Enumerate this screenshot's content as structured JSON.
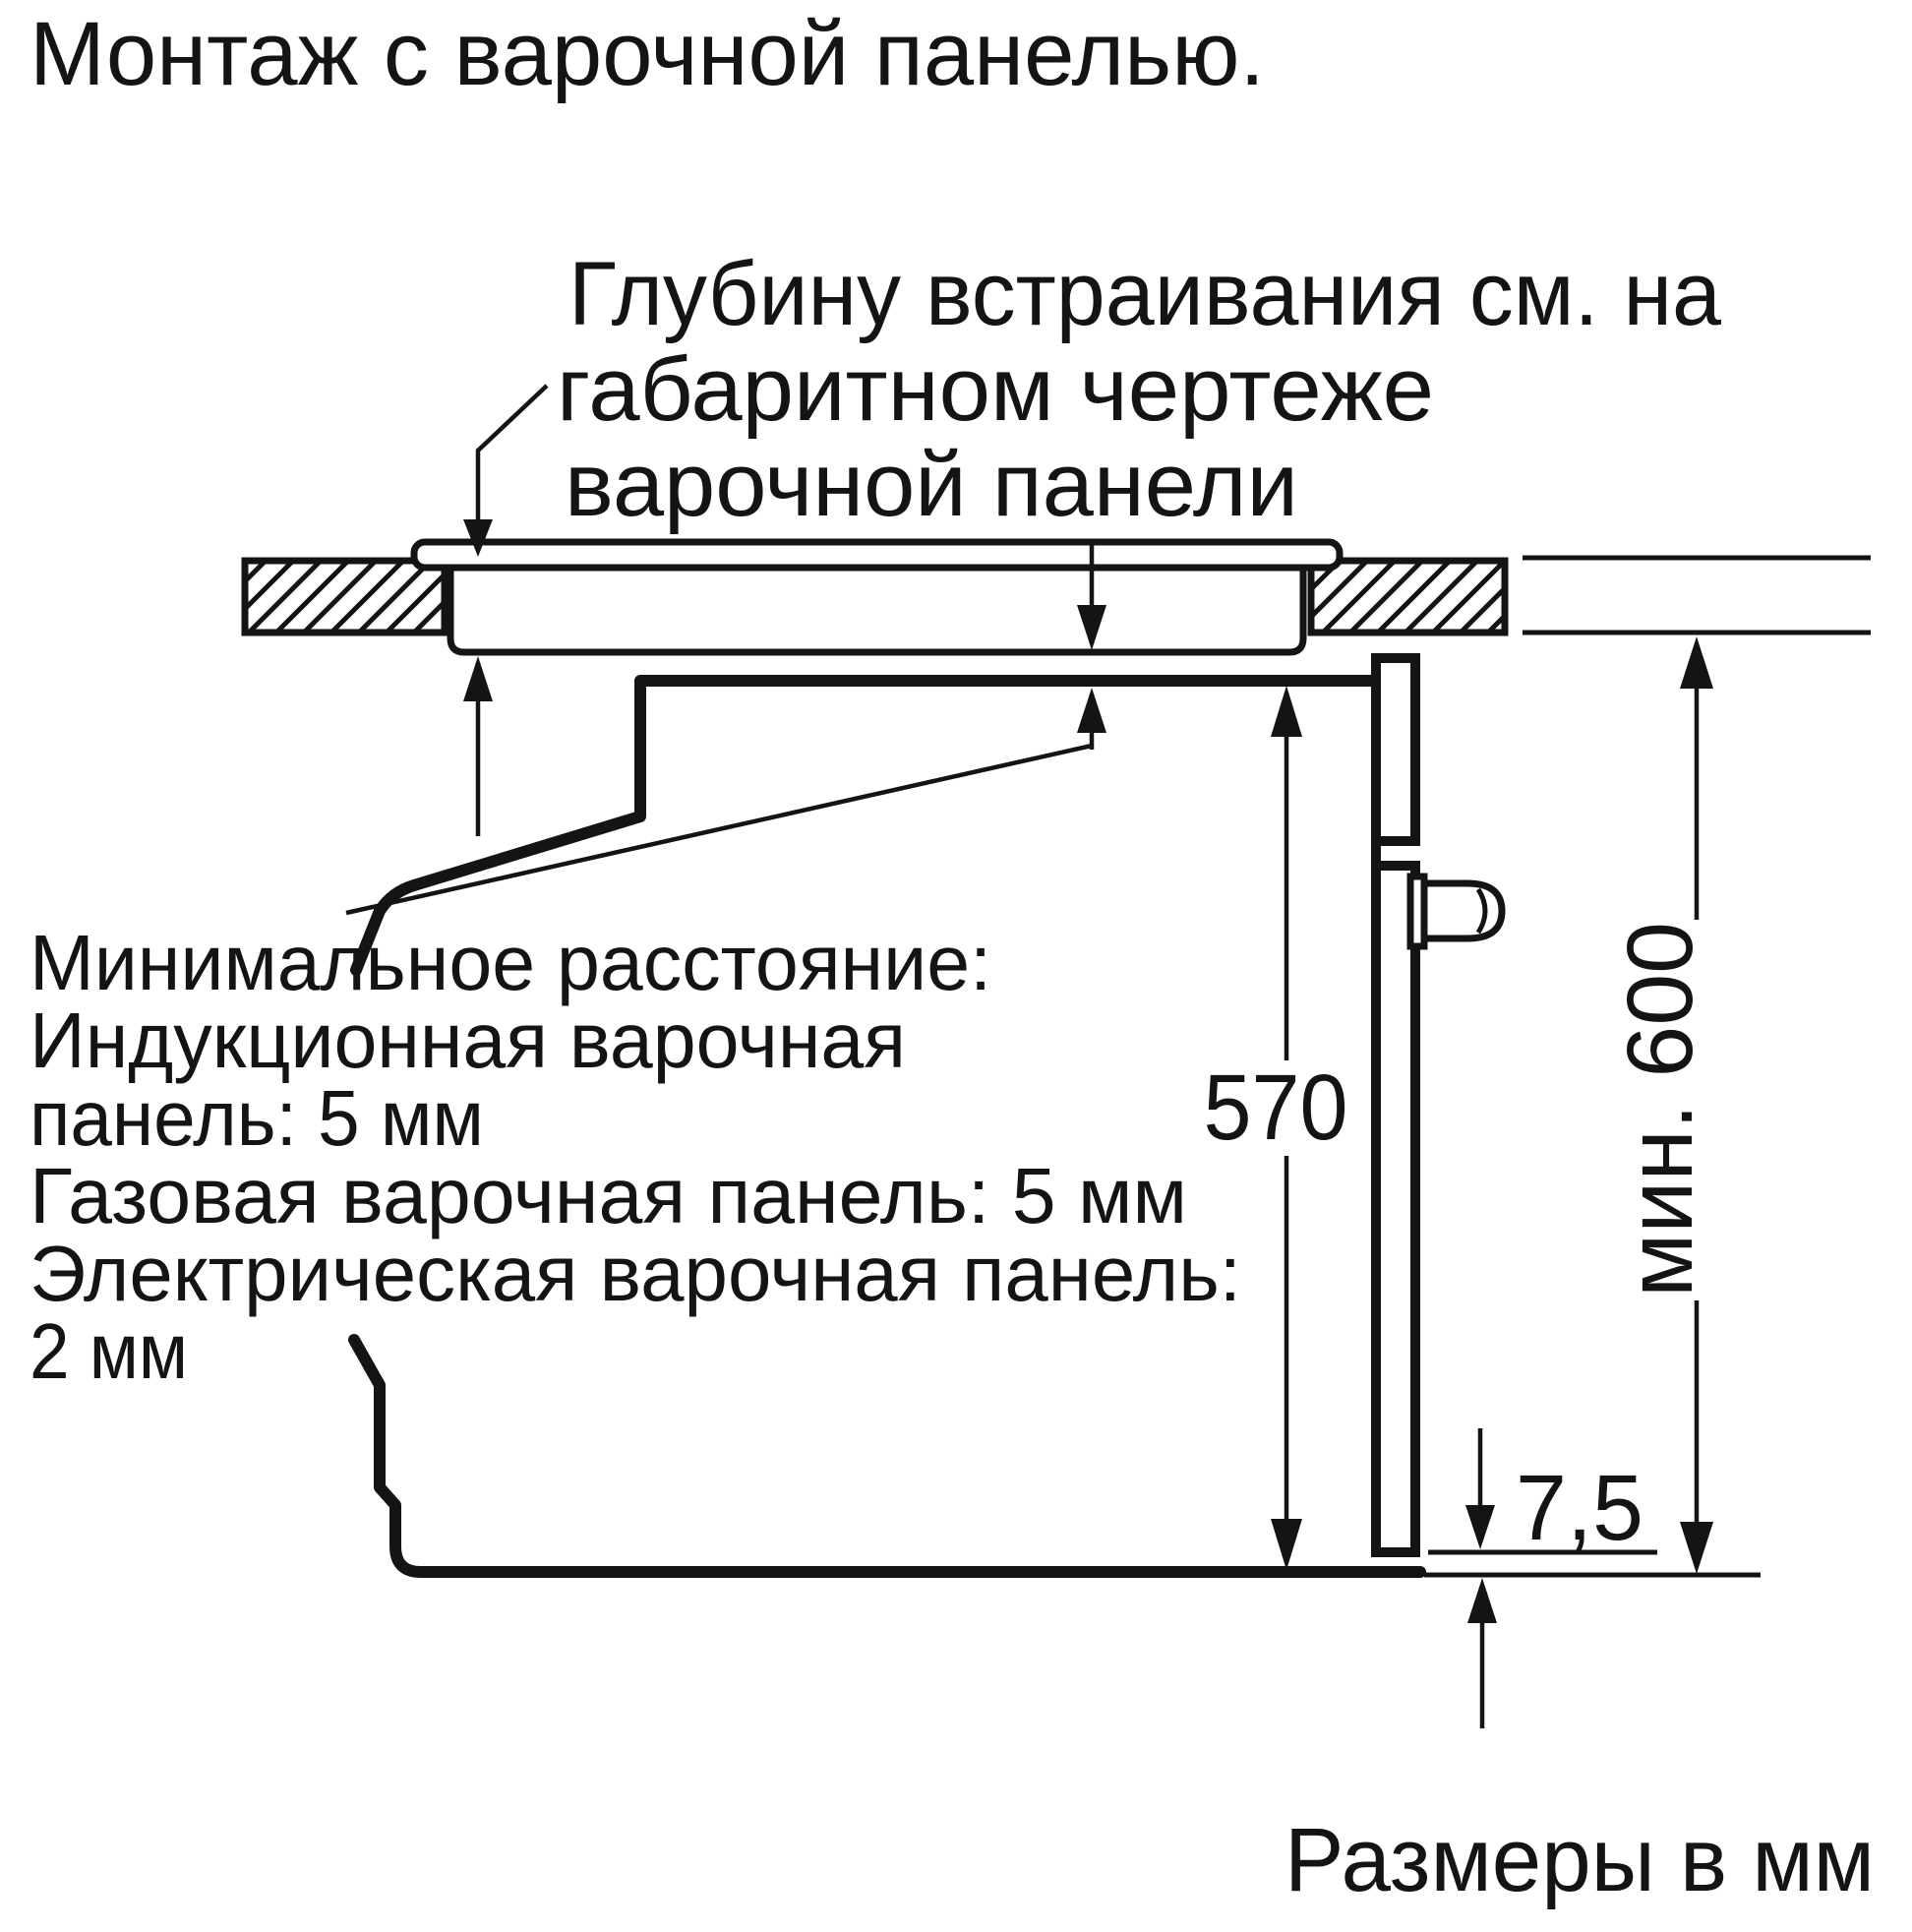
{
  "colors": {
    "background": "#ffffff",
    "ink": "#141414"
  },
  "title": "Монтаж с варочной панелью.",
  "callout": {
    "lines": [
      "Глубину встраивания см. на",
      "габаритном чертеже",
      "варочной панели"
    ]
  },
  "note": {
    "lines": [
      "Минимальное расстояние:",
      "Индукционная варочная",
      "панель: 5 мм",
      "Газовая варочная панель: 5 мм",
      "Электрическая варочная панель:",
      "2 мм"
    ]
  },
  "dimensions": {
    "cavity_height": "570",
    "min_worktop_clearance": "мин. 600",
    "door_bottom_gap": "7,5"
  },
  "footer": "Размеры в мм"
}
